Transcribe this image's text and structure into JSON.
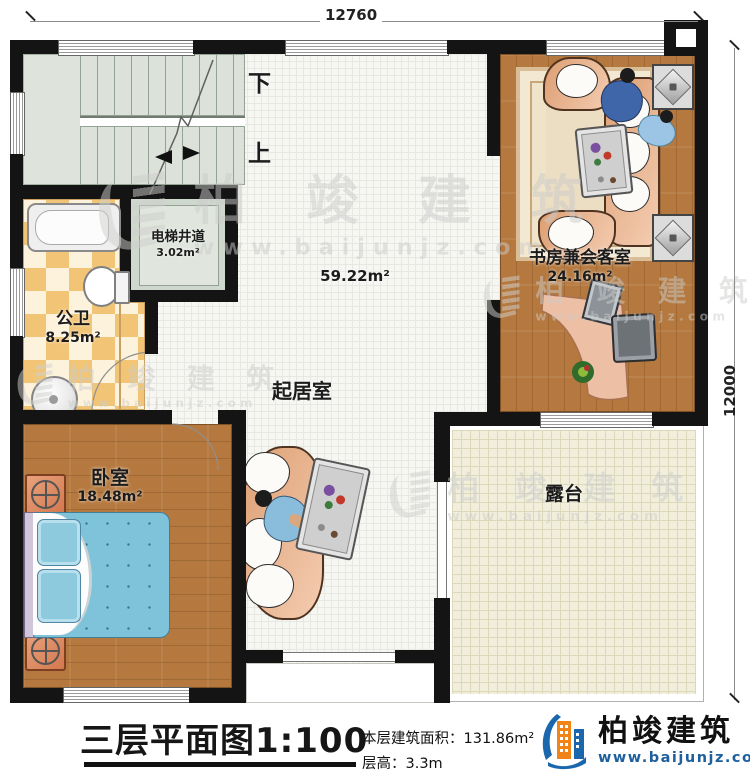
{
  "dimensions": {
    "top": "12760",
    "right": "12000"
  },
  "stairs": {
    "down_label": "下",
    "up_label": "上"
  },
  "rooms": {
    "elevator": {
      "name": "电梯井道",
      "area": "3.02m²"
    },
    "bathroom": {
      "name": "公卫",
      "area": "8.25m²"
    },
    "living": {
      "name": "起居室",
      "area": "59.22m²"
    },
    "study": {
      "name": "书房兼会客室",
      "area": "24.16m²"
    },
    "bedroom": {
      "name": "卧室",
      "area": "18.48m²"
    },
    "terrace": {
      "name": "露台"
    }
  },
  "title_block": {
    "title": "三层平面图1:100",
    "area_line": "本层建筑面积：131.86m²",
    "height_line": "层高：3.3m"
  },
  "branding": {
    "name": "柏竣建筑",
    "url": "www.baijunjz.com"
  },
  "watermark": {
    "name": "柏竣建筑",
    "url": "www.baijunjz.com"
  },
  "icons": {
    "brand_logo": "building-swoosh-mark",
    "watermark_mark": "building-swoosh-mark"
  },
  "colors": {
    "wall": "#141414",
    "wood_floor": "#b5793f",
    "bath_tile": "#f2c475",
    "terrace_tile": "#f1efdc",
    "stair": "#dee4db",
    "sofa": "#e9b28c",
    "bed": "#7fc3da",
    "brand_blue": "#1a67ae",
    "brand_orange": "#f08419"
  }
}
